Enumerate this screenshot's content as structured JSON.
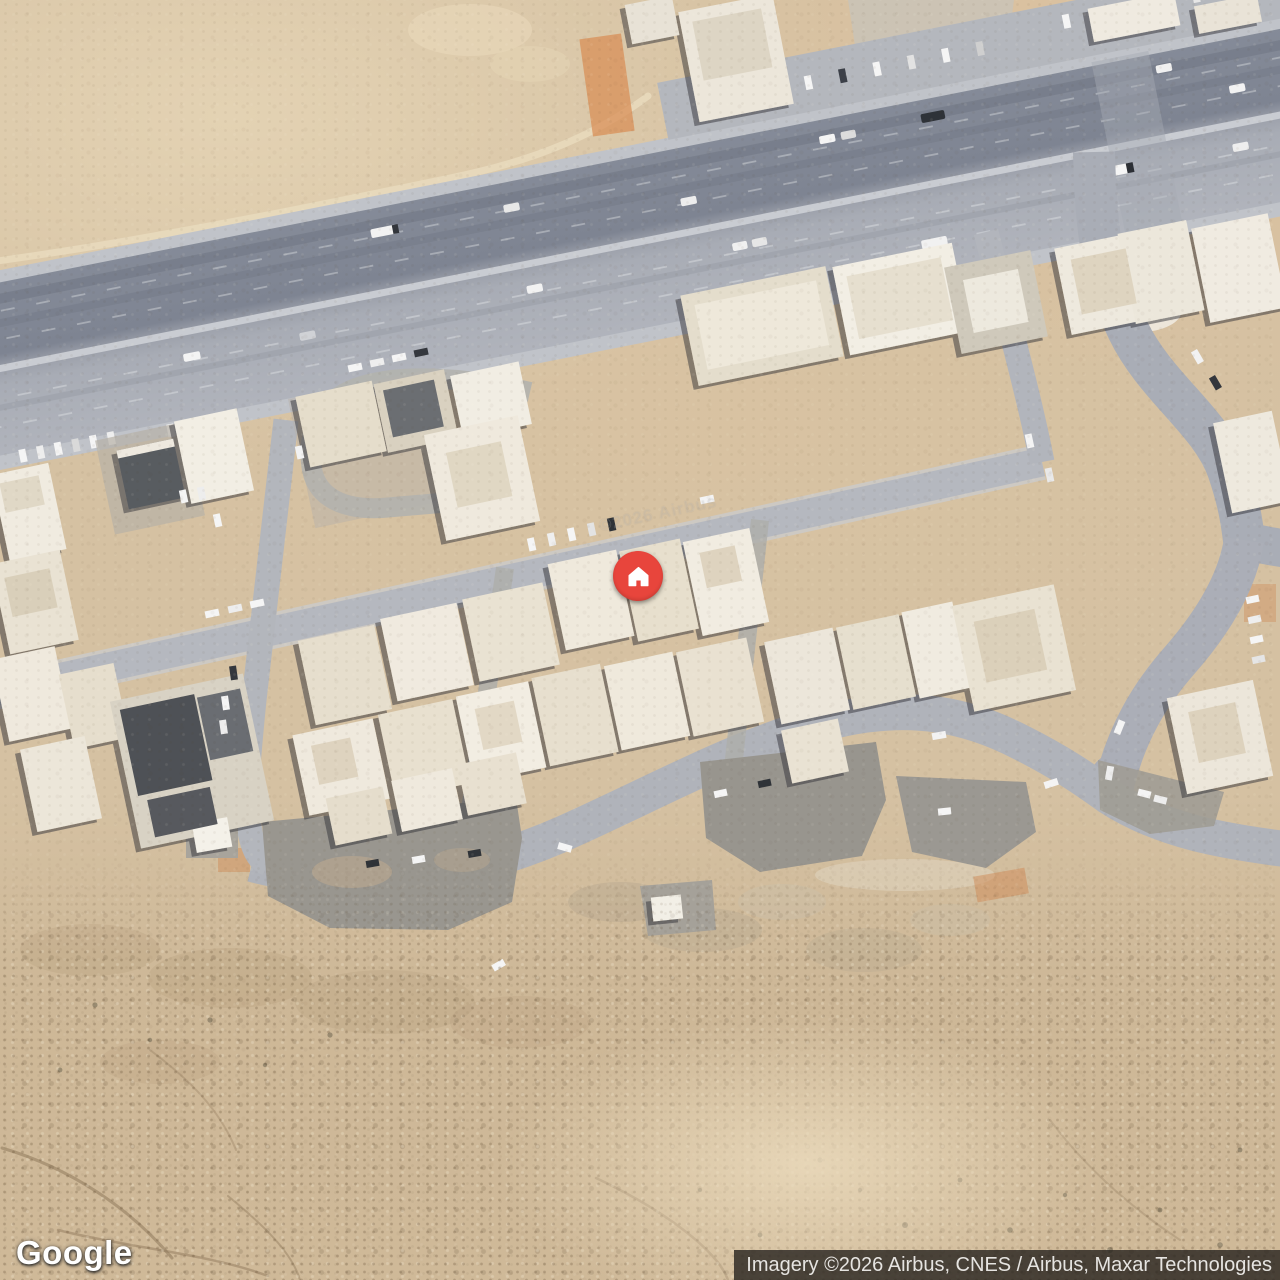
{
  "map": {
    "view_type": "satellite",
    "scene": "desert town with diagonal divided highway, residential blocks and curving streets"
  },
  "marker": {
    "icon": "house-icon",
    "color": "#E8453C"
  },
  "footer": {
    "logo_text": "Google",
    "attribution": "Imagery ©2026 Airbus, CNES / Airbus, Maxar Technologies"
  },
  "watermark": {
    "text": "©2026 Airbus"
  },
  "colors": {
    "marker_red": "#E8453C",
    "sand_base": "#D5C1A2",
    "highway_dark": "#7E8492",
    "highway_light": "#A8ACB5",
    "street": "#B5B8BF",
    "parking_asphalt": "#99968F",
    "building_light": "#F0EBE0",
    "attribution_bg": "rgba(38,34,30,0.8)",
    "attribution_text": "#E6E4E1"
  }
}
